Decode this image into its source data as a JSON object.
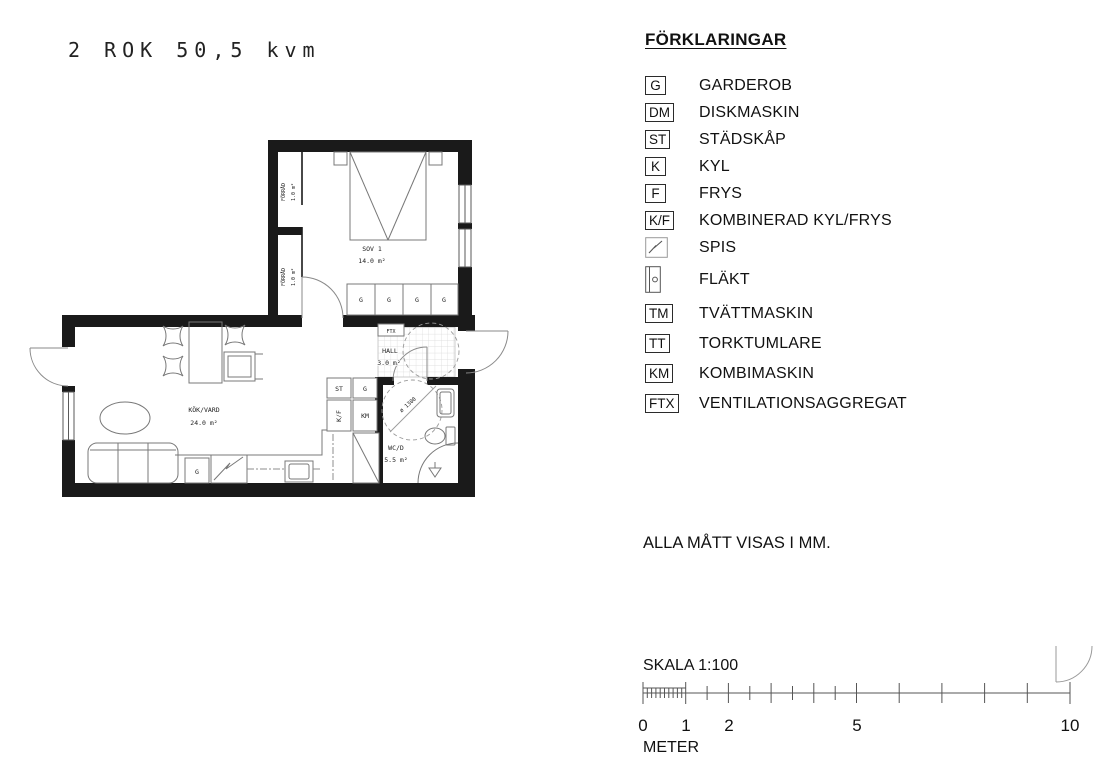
{
  "title": "2 ROK 50,5 kvm",
  "legend": {
    "heading": "FÖRKLARINGAR",
    "items": [
      {
        "symbol": "G",
        "label": "GARDEROB"
      },
      {
        "symbol": "DM",
        "label": "DISKMASKIN"
      },
      {
        "symbol": "ST",
        "label": "STÄDSKÅP"
      },
      {
        "symbol": "K",
        "label": "KYL"
      },
      {
        "symbol": "F",
        "label": "FRYS"
      },
      {
        "symbol": "K/F",
        "label": "KOMBINERAD KYL/FRYS"
      },
      {
        "icon": "spis-icon",
        "label": "SPIS"
      },
      {
        "icon": "flakt-icon",
        "label": "FLÄKT"
      },
      {
        "symbol": "TM",
        "label": "TVÄTTMASKIN"
      },
      {
        "symbol": "TT",
        "label": "TORKTUMLARE"
      },
      {
        "symbol": "KM",
        "label": "KOMBIMASKIN"
      },
      {
        "symbol": "FTX",
        "label": "VENTILATIONSAGGREGAT"
      }
    ]
  },
  "note": "ALLA MÅTT VISAS I MM.",
  "scale": {
    "label": "SKALA 1:100",
    "unit": "METER",
    "ticks": [
      "0",
      "1",
      "2",
      "5",
      "10"
    ]
  },
  "floorplan": {
    "rooms": {
      "sov": {
        "name": "SOV 1",
        "area": "14.0 m²"
      },
      "kok": {
        "name": "KÖK/VARD",
        "area": "24.0 m²"
      },
      "hall": {
        "name": "HALL",
        "area": "3.0 m²"
      },
      "wc": {
        "name": "WC/D",
        "area": "5.5 m²"
      },
      "forrad": {
        "name": "FÖRRÅD",
        "area": "1.0 m²"
      }
    },
    "labels": {
      "garderob": "G",
      "stadskap": "ST",
      "kylfrys": "K/F",
      "kombimaskin": "KM",
      "ftx": "FTX",
      "turning_circle": "ø 1300"
    }
  },
  "colors": {
    "wall": "#1a1a1a",
    "furniture_line": "#787878",
    "dashed_line": "#999999"
  }
}
